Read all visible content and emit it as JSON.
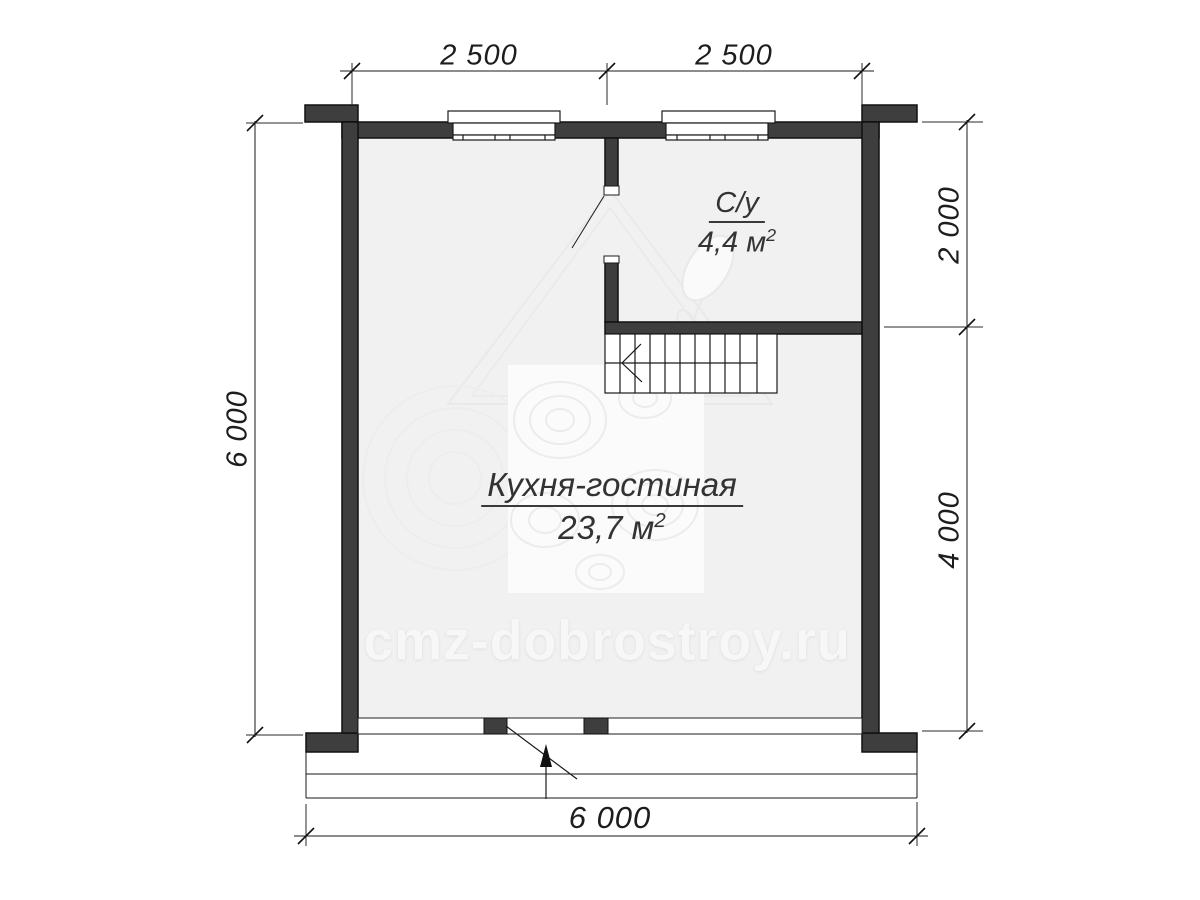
{
  "plan": {
    "rooms": [
      {
        "name": "С/у",
        "area": "4,4 м",
        "area_exp": "2"
      },
      {
        "name": "Кухня-гостиная",
        "area": "23,7 м",
        "area_exp": "2"
      }
    ],
    "dimensions": {
      "top": [
        {
          "label": "2 500"
        },
        {
          "label": "2 500"
        }
      ],
      "left": [
        {
          "label": "6 000"
        }
      ],
      "right": [
        {
          "label": "2 000"
        },
        {
          "label": "4 000"
        }
      ],
      "bottom": [
        {
          "label": "6 000"
        }
      ]
    },
    "watermark_text": "cmz-dobrostroy.ru",
    "colors": {
      "wall": "#3e3e3e",
      "floor": "#f1f1f1",
      "line": "#1a1a1a",
      "label_text": "#333333",
      "watermark": "#f7f7f7"
    }
  }
}
